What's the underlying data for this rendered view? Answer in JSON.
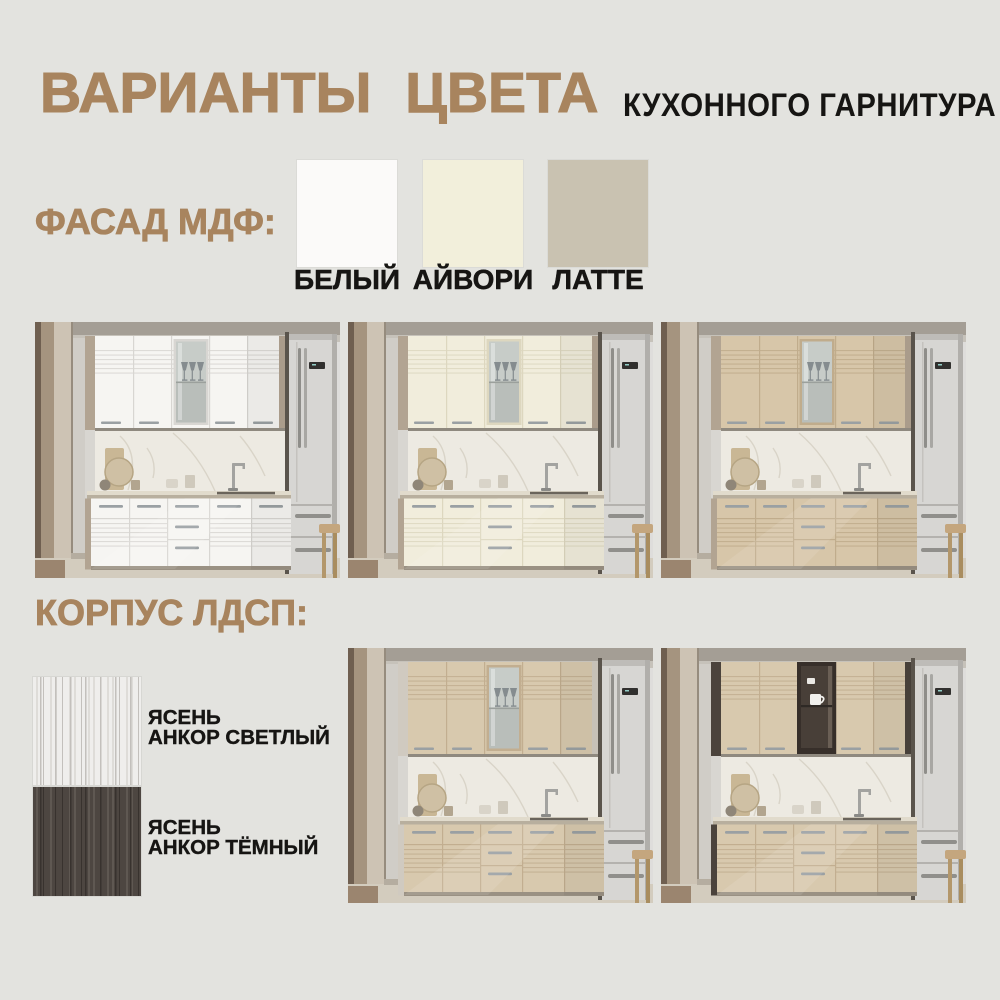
{
  "page": {
    "background": "#e3e3df"
  },
  "header": {
    "title": "ВАРИАНТЫ ЦВЕТА",
    "subtitle": "КУХОННОГО ГАРНИТУРА",
    "title_color": "#a8845e",
    "subtitle_color": "#161513"
  },
  "facade_section": {
    "label": "ФАСАД МДФ:",
    "label_color": "#a8845e",
    "swatches": [
      {
        "name": "БЕЛЫЙ",
        "color": "#fbfaf9"
      },
      {
        "name": "АЙВОРИ",
        "color": "#f2efdb"
      },
      {
        "name": "ЛАТТЕ",
        "color": "#c9c2b1"
      }
    ]
  },
  "carcass_section": {
    "label": "КОРПУС ЛДСП:",
    "label_color": "#a8845e",
    "swatches": [
      {
        "line1": "ЯСЕНЬ",
        "line2": "АНКОР СВЕТЛЫЙ",
        "base": "#efeeec",
        "streak_light": "#dedcd8",
        "streak_dark": "#c3c0bc"
      },
      {
        "line1": "ЯСЕНЬ",
        "line2": "АНКОР ТЁМНЫЙ",
        "base": "#4d4641",
        "streak_light": "#5f5852",
        "streak_dark": "#38322e"
      }
    ]
  },
  "photos": [
    {
      "name": "kitchen-facade-white",
      "facade": "#f6f5f2",
      "facade_line": "#d8d6d2",
      "body": "#b2a492",
      "body_edge": "#8f8273",
      "glass": "frosted"
    },
    {
      "name": "kitchen-facade-ivory",
      "facade": "#f1eddc",
      "facade_line": "#ddd7bf",
      "body": "#b2a492",
      "body_edge": "#8f8273",
      "glass": "frosted"
    },
    {
      "name": "kitchen-facade-latte",
      "facade": "#d7c6a9",
      "facade_line": "#c0ac8c",
      "body": "#b2a492",
      "body_edge": "#8f8273",
      "glass": "frosted"
    },
    {
      "name": "kitchen-carcass-light-ash",
      "facade": "#d8c9ae",
      "facade_line": "#c2ae90",
      "body": "#d0cac0",
      "body_edge": "#aaa296",
      "glass": "frosted"
    },
    {
      "name": "kitchen-carcass-dark-ash",
      "facade": "#d8c9ae",
      "facade_line": "#c2ae90",
      "body": "#4b433c",
      "body_edge": "#372f2a",
      "glass": "open"
    }
  ]
}
